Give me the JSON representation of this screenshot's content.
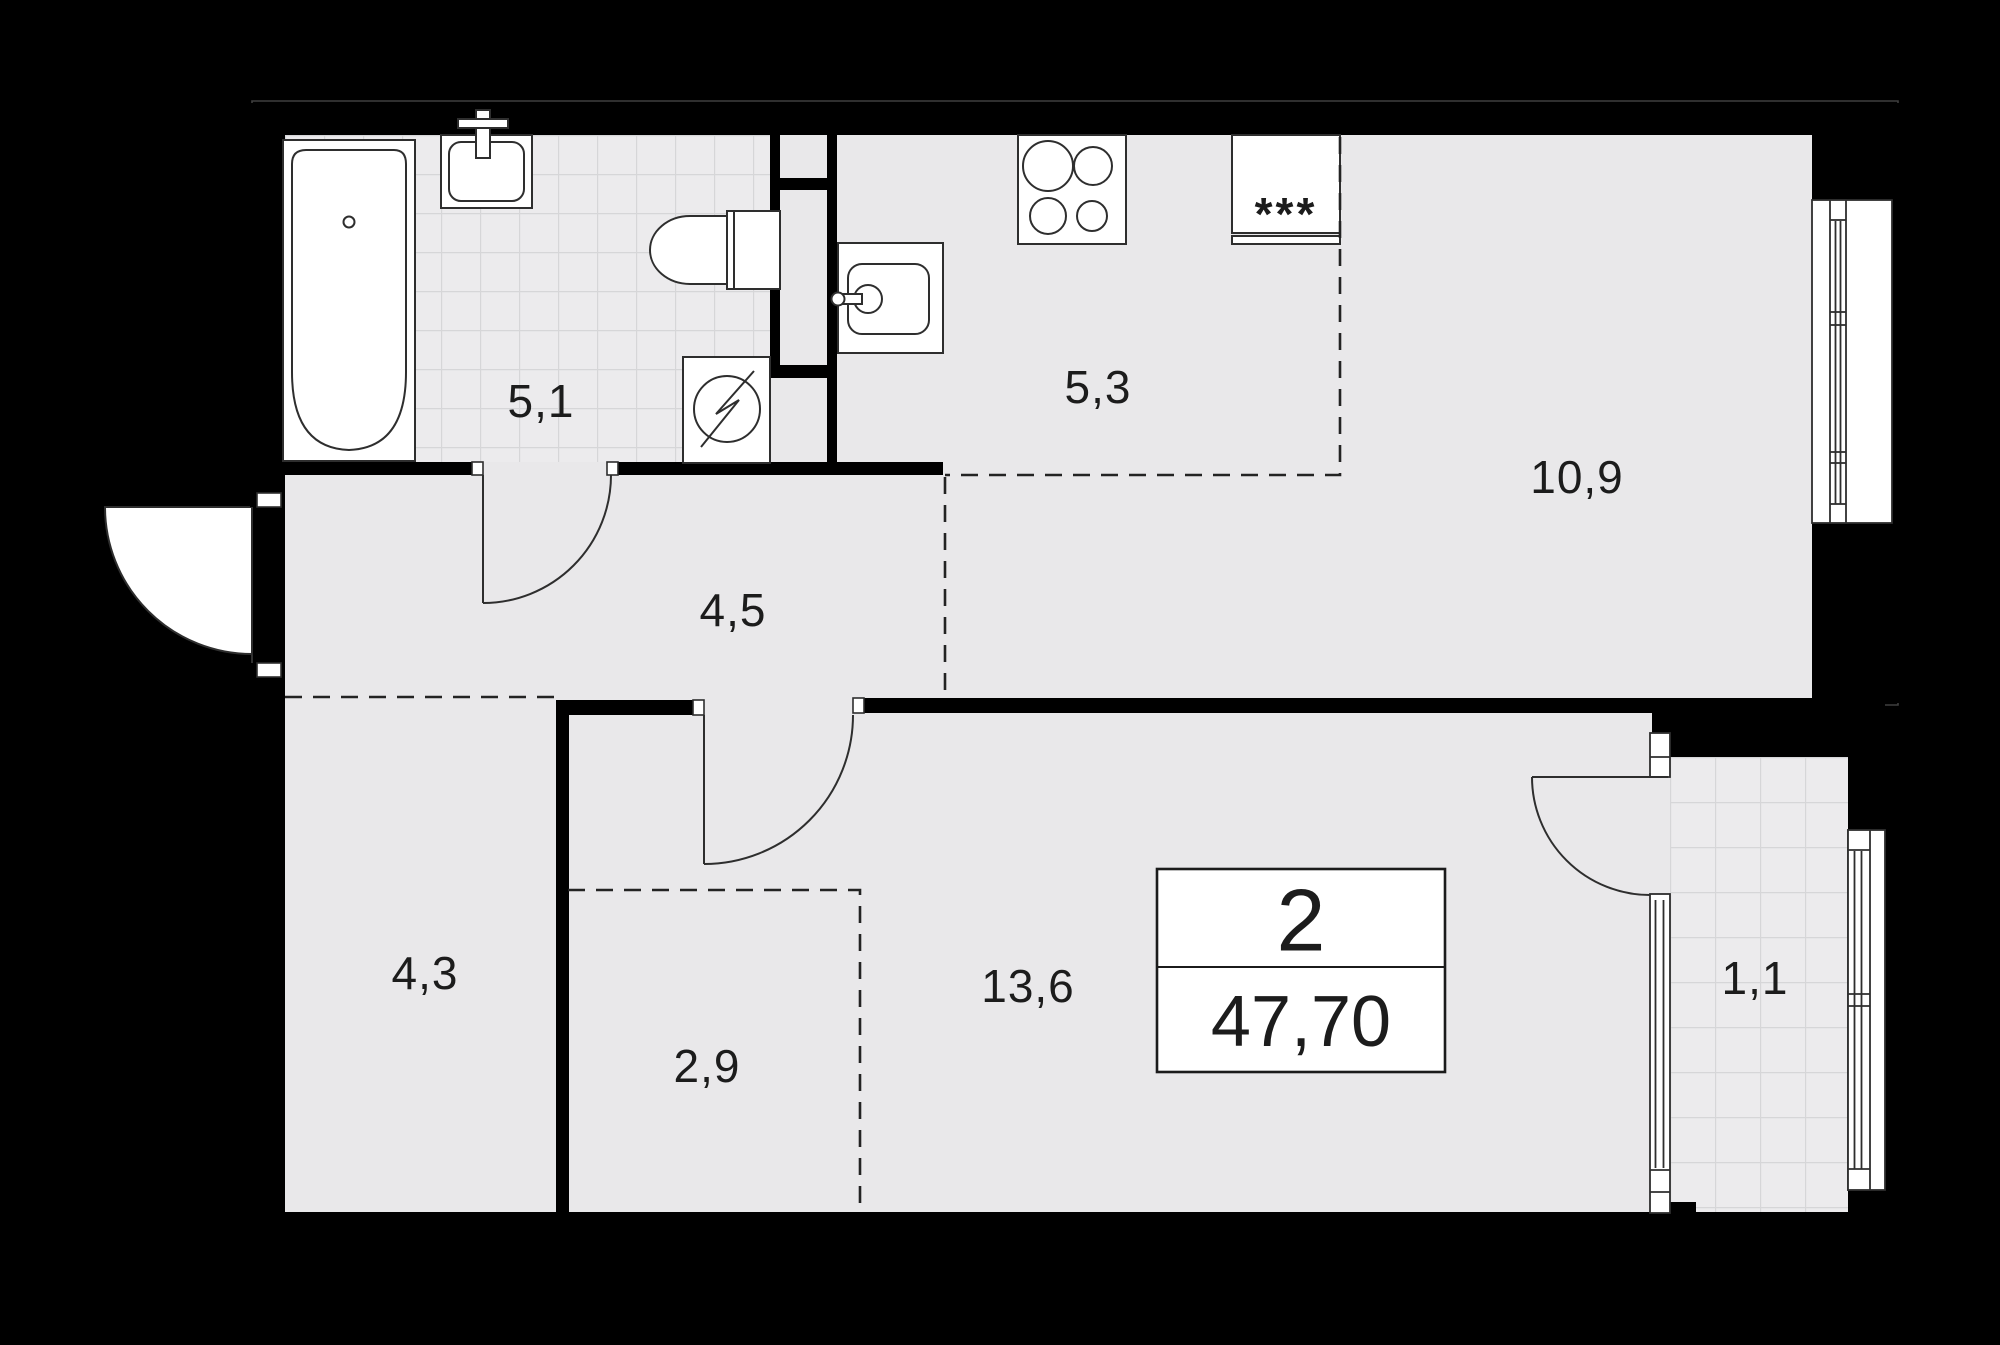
{
  "plan": {
    "unit": {
      "rooms_count": "2",
      "total_area": "47,70"
    },
    "rooms": [
      {
        "id": "bathroom",
        "label": "5,1"
      },
      {
        "id": "kitchen",
        "label": "5,3"
      },
      {
        "id": "living-kitchen",
        "label": "10,9"
      },
      {
        "id": "hallway",
        "label": "4,5"
      },
      {
        "id": "room-small",
        "label": "4,3"
      },
      {
        "id": "wardrobe",
        "label": "2,9"
      },
      {
        "id": "bedroom",
        "label": "13,6"
      },
      {
        "id": "balcony",
        "label": "1,1"
      }
    ],
    "fridge_symbol": "***",
    "colors": {
      "background": "#000000",
      "floor": "#e9e8ea",
      "wall": "#000000",
      "fixture_line": "#2e2e2e",
      "tile_line": "#d3d2d5",
      "label": "#1c1c1c"
    }
  }
}
